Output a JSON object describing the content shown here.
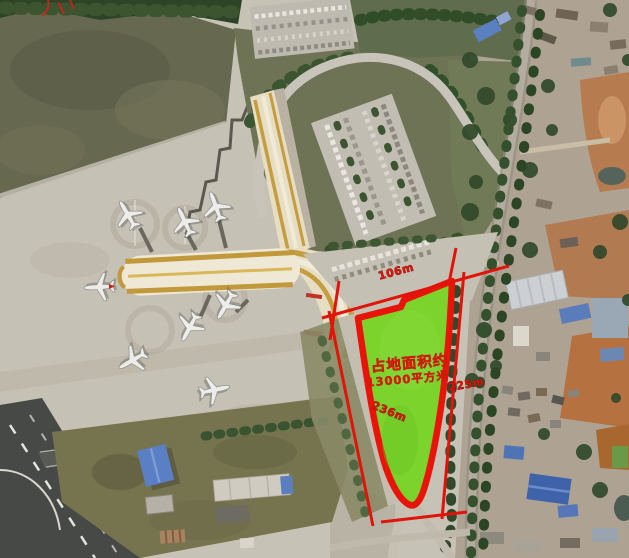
{
  "scene": {
    "type": "satellite-aerial-photo",
    "description": "Satellite view of an airport terminal and apron on the left, a village and road on the right, with a land parcel highlighted in green and outlined in red with dimension annotations"
  },
  "annotations": {
    "area_label": {
      "line1": "占地面积约",
      "line2": "13000平方米"
    },
    "dimensions": {
      "top": "106m",
      "right": "225m",
      "left": "236m"
    }
  },
  "colors": {
    "annotation_red": "#e01408",
    "parcel_fill": "#7bd32c",
    "terminal_gold": "#c49d40",
    "apron_gray": "#c6c1b5",
    "field_olive": "#66684f",
    "tree_green": "#33502b",
    "blue_roof": "#5a7fc4",
    "bare_earth": "#b5713f",
    "asphalt_dark": "#474946"
  }
}
